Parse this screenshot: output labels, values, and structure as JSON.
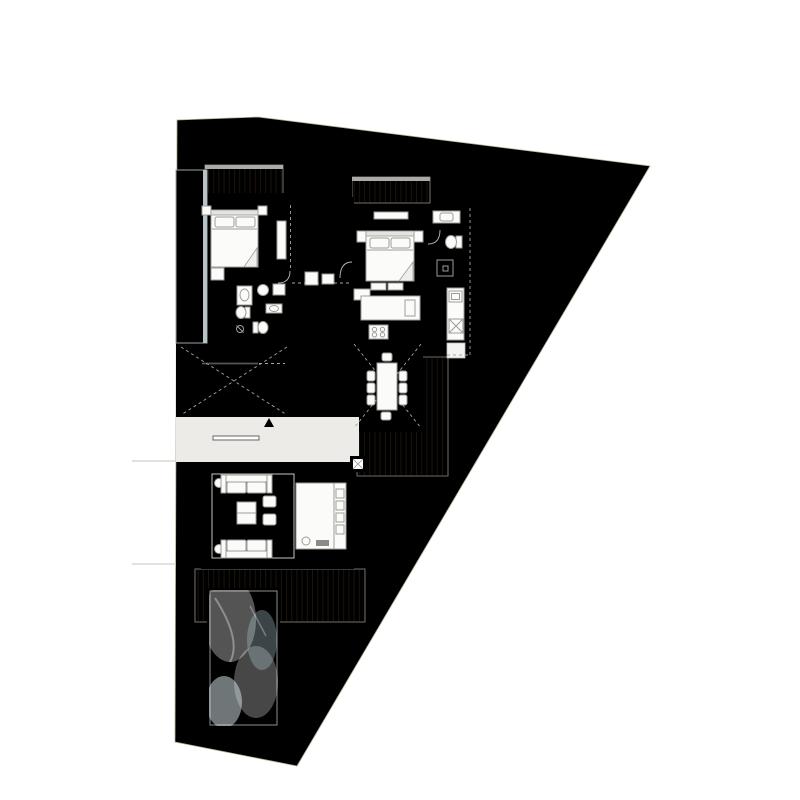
{
  "header": {
    "title": "EARTH VILLA",
    "subtitle": "GROUND FLOOR PLAN"
  },
  "palette": {
    "title_color": "#6f6f6f",
    "subtitle_color": "#9d9d9d",
    "grass": "#cdd8b8",
    "tree": "#9cb183",
    "wood": "#b28f75",
    "wall": "#1d1d1d",
    "floor": "#eeedea",
    "bath_floor": "#d9d9d6",
    "pergola": "#e3e8ea",
    "pergola_slat": "#c2cdd1",
    "water": "#c2d8de",
    "water_border": "#87908f",
    "stone": "#ebeae0"
  }
}
